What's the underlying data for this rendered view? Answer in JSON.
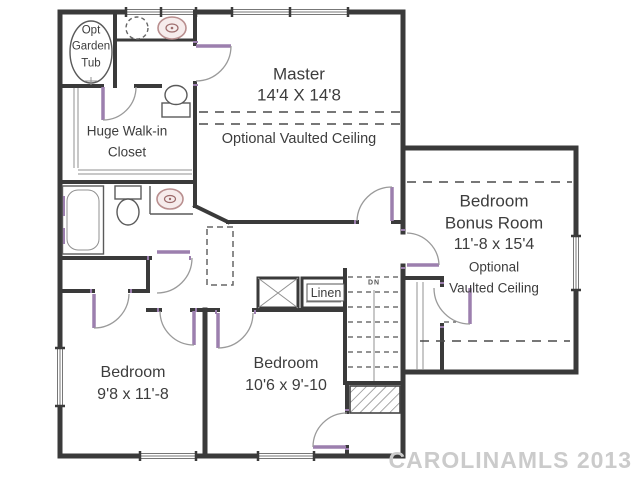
{
  "title": "Second floor plan",
  "watermark": "CAROLINAMLS 2013",
  "rooms": {
    "master": {
      "name": "Master",
      "dims": "14'4 X 14'8",
      "ceiling": "Optional Vaulted Ceiling"
    },
    "bonus": {
      "name_line1": "Bedroom",
      "name_line2": "Bonus Room",
      "dims": "11'-8 x 15'4",
      "ceiling_line1": "Optional",
      "ceiling_line2": "Vaulted Ceiling"
    },
    "bedroom_left": {
      "name": "Bedroom",
      "dims": "9'8 x 11'-8"
    },
    "bedroom_middle": {
      "name": "Bedroom",
      "dims": "10'6 x 9'-10"
    },
    "walk_in_closet": {
      "name_line1": "Huge Walk-in",
      "name_line2": "Closet"
    },
    "garden_tub": {
      "label_line1": "Opt",
      "label_line2": "Garden",
      "label_line3": "Tub"
    },
    "linen_closet": {
      "label": "Linen"
    },
    "stairs": {
      "direction_label": "DN"
    }
  },
  "fixtures": [
    "garden-tub",
    "toilet",
    "vanity-sink",
    "bathtub",
    "toilet",
    "sink",
    "linen-shelves",
    "attic-access",
    "chase",
    "stairs-down",
    "hatched-storage"
  ],
  "colors": {
    "wall": "#3a3a3a",
    "arc": "#9a9a9a",
    "leaf": "#9c7fae",
    "pink": "#b98f8f",
    "dashline": "#4a4a4a",
    "text": "#3d3d3d",
    "watermark": "#cbcbcb",
    "bg": "#ffffff"
  }
}
